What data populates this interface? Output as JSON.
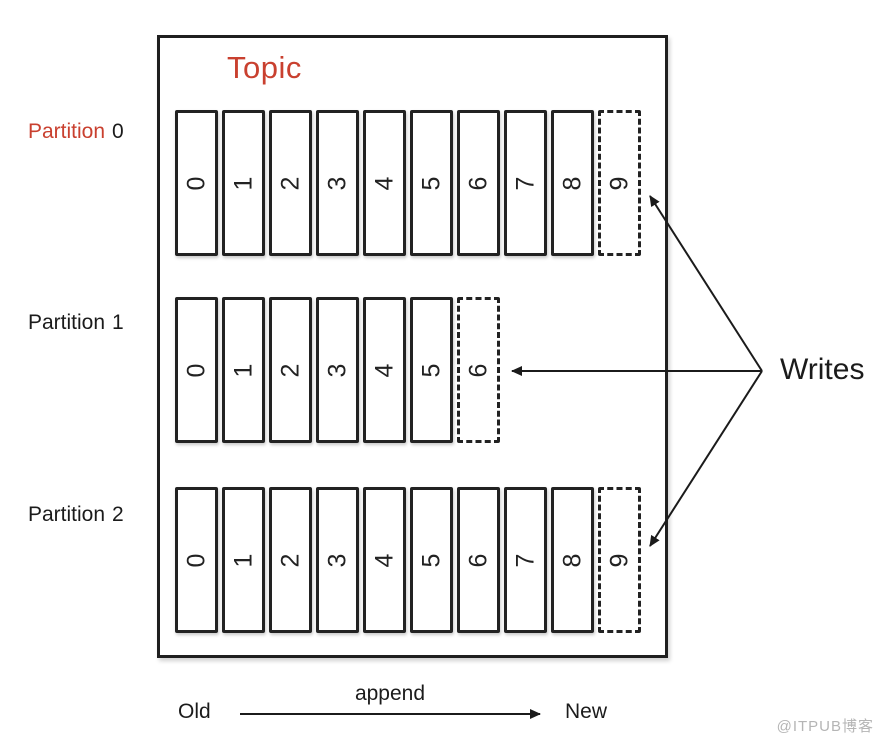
{
  "topic": {
    "title": "Topic",
    "title_color": "#c9402f"
  },
  "partitions": [
    {
      "label_prefix": "Partition",
      "label_number": "0",
      "label_prefix_color": "#c9402f",
      "cells": [
        "0",
        "1",
        "2",
        "3",
        "4",
        "5",
        "6",
        "7",
        "8"
      ],
      "next_cell": "9"
    },
    {
      "label_prefix": "Partition",
      "label_number": "1",
      "label_prefix_color": "#1b1b1b",
      "cells": [
        "0",
        "1",
        "2",
        "3",
        "4",
        "5"
      ],
      "next_cell": "6"
    },
    {
      "label_prefix": "Partition",
      "label_number": "2",
      "label_prefix_color": "#1b1b1b",
      "cells": [
        "0",
        "1",
        "2",
        "3",
        "4",
        "5",
        "6",
        "7",
        "8"
      ],
      "next_cell": "9"
    }
  ],
  "writes_label": "Writes",
  "legend": {
    "old": "Old",
    "append": "append",
    "new": "New"
  },
  "watermark": "@ITPUB博客",
  "colors": {
    "accent_red": "#c9402f",
    "line": "#1b1b1b",
    "watermark_gray": "#b5b5b5"
  }
}
